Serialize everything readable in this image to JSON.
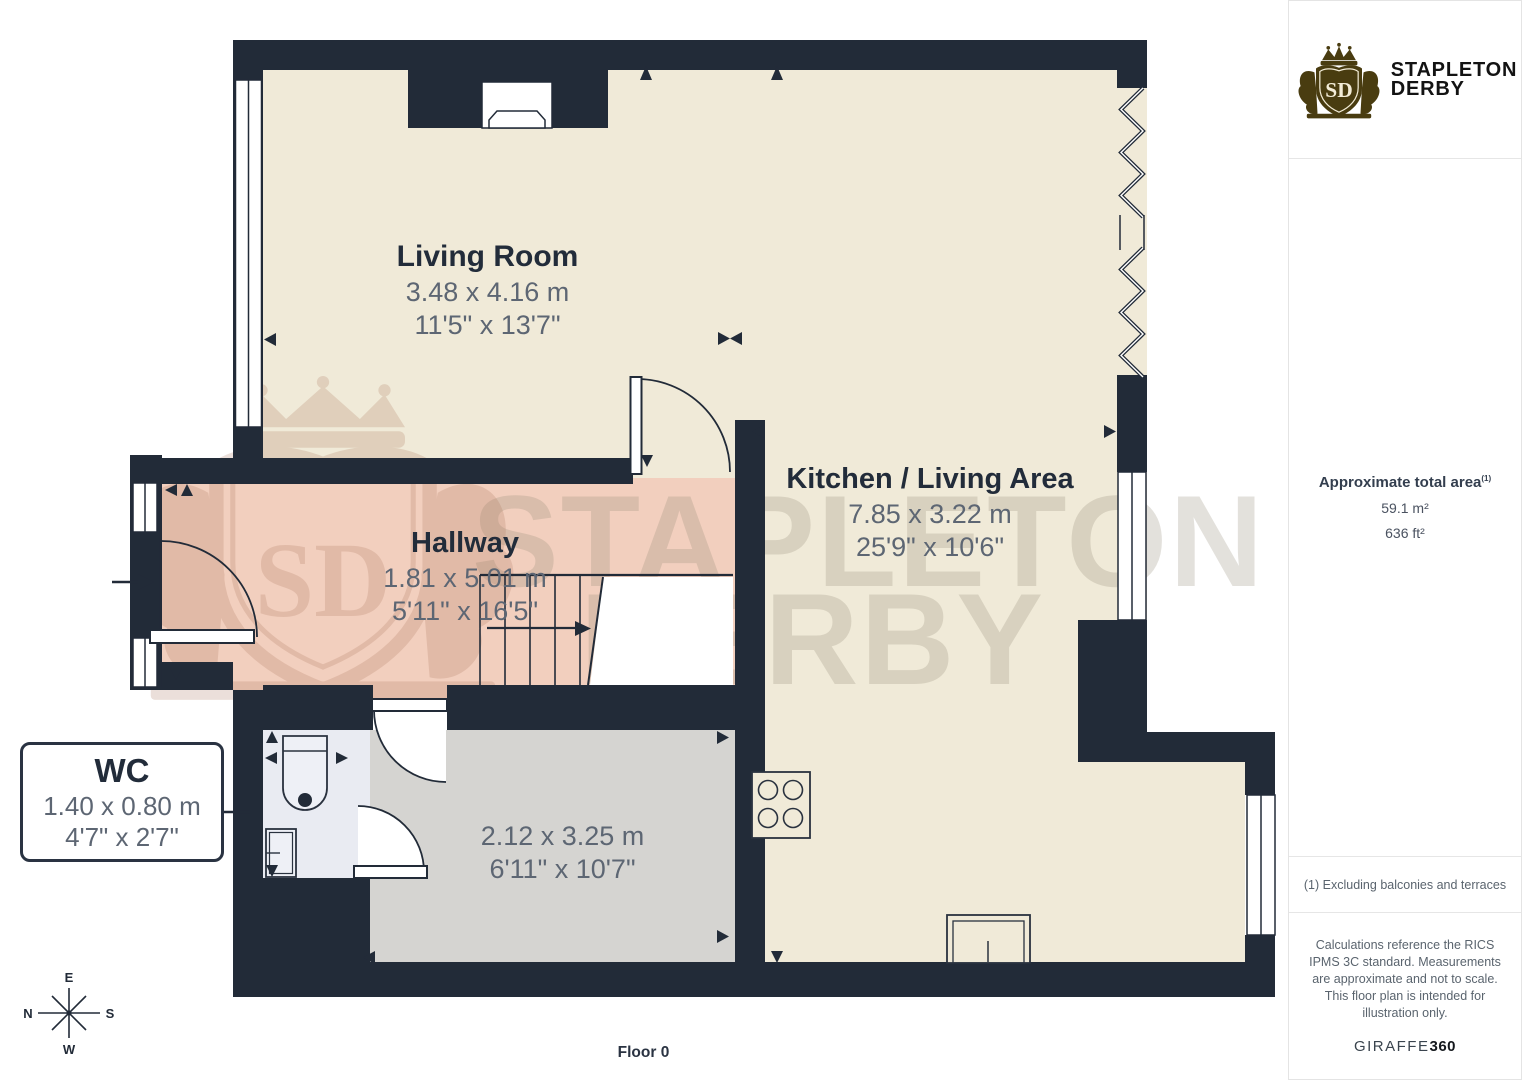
{
  "page": {
    "floor_label": "Floor 0"
  },
  "colors": {
    "wall": "#222b38",
    "room_cream": "#f0ead8",
    "hallway_pink": "#f2cfbe",
    "room_gray": "#d5d4d1",
    "wc_blue": "#e9ebf2",
    "label_dark": "#222c3a",
    "label_gray": "#5d6673",
    "logo_gold": "#493c10"
  },
  "branding": {
    "monogram": "SD",
    "line1": "STAPLETON",
    "line2": "DERBY"
  },
  "watermark": {
    "line1": "STAPLETON",
    "line2": "DERBY",
    "monogram": "SD"
  },
  "rooms": {
    "living": {
      "name": "Living Room",
      "metric": "3.48 x 4.16 m",
      "imperial": "11'5\" x 13'7\""
    },
    "kitchen": {
      "name": "Kitchen / Living Area",
      "metric": "7.85 x 3.22 m",
      "imperial": "25'9\" x 10'6\""
    },
    "hallway": {
      "name": "Hallway",
      "metric": "1.81 x 5.01 m",
      "imperial": "5'11\" x 16'5\""
    },
    "room": {
      "metric": "2.12 x 3.25 m",
      "imperial": "6'11\" x 10'7\""
    },
    "wc": {
      "name": "WC",
      "metric": "1.40 x 0.80 m",
      "imperial": "4'7\" x 2'7\""
    }
  },
  "compass": {
    "top": "E",
    "left": "N",
    "right": "S",
    "bottom": "W"
  },
  "sidebar": {
    "area_title": "Approximate total area",
    "area_footnote_ref": "(1)",
    "area_sqm": "59.1 m²",
    "area_sqft": "636 ft²",
    "footnote": "(1) Excluding balconies and terraces",
    "disclaimer": "Calculations reference the RICS IPMS 3C standard. Measurements are approximate and not to scale. This floor plan is intended for illustration only.",
    "provider": {
      "name": "GIRAFFE",
      "suffix": "360"
    }
  }
}
